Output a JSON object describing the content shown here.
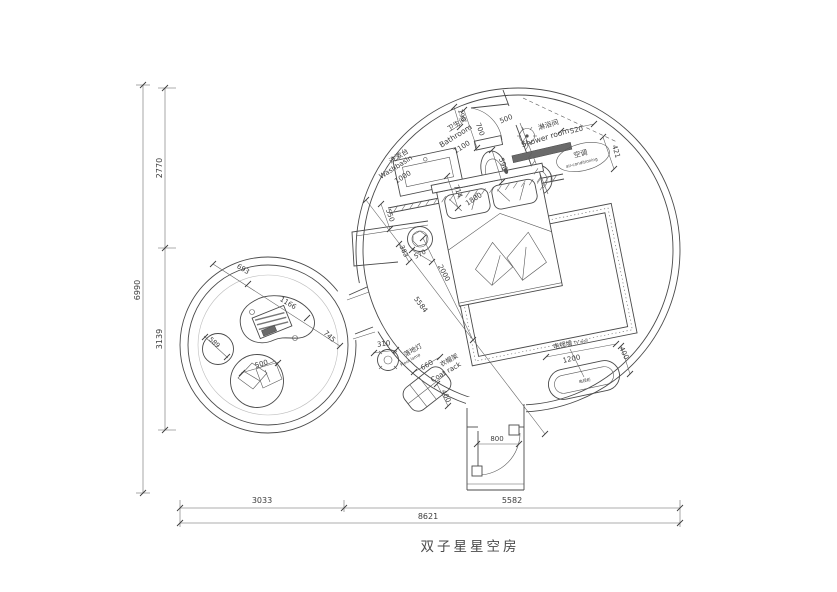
{
  "title": "双子星星空房",
  "drawing": {
    "line_color": "#4a4a4a",
    "background": "#ffffff"
  },
  "rooms": {
    "bathroom": {
      "zh": "卫生间",
      "en": "Bathroom"
    },
    "washbasin": {
      "zh": "洗漱台",
      "en": "Washbasin"
    },
    "shower": {
      "zh": "淋浴间",
      "en": "Shower room"
    },
    "air_conditioner": {
      "zh": "空调",
      "en": "air-conditioning"
    },
    "floor_lamp": {
      "zh": "落地灯",
      "en": "Floor lamp"
    },
    "coat_rack": {
      "zh": "衣帽架",
      "en": "Coat rack"
    },
    "tv_wall": {
      "zh": "电视墙",
      "en": "TV wall"
    },
    "tv_cabinet": {
      "zh": "电视柜"
    }
  },
  "overall_dimensions": {
    "total_width": "8621",
    "total_height": "6990",
    "left_top": "2770",
    "left_bottom": "3139",
    "bottom_left": "3033",
    "bottom_right": "5582"
  },
  "plan": {
    "labels": [
      {
        "n": "label-washbasin-zh",
        "t": "洗漱台",
        "x": 400,
        "y": 158,
        "r": -32,
        "s": 7
      },
      {
        "n": "label-washbasin-en",
        "t": "Washbasin",
        "x": 397,
        "y": 169,
        "r": -32,
        "s": 7
      },
      {
        "n": "dim-1000",
        "t": "1000",
        "x": 404,
        "y": 179,
        "r": -32,
        "s": 7
      },
      {
        "n": "label-bathroom-zh",
        "t": "卫生间",
        "x": 458,
        "y": 126,
        "r": -32,
        "s": 7
      },
      {
        "n": "label-bathroom-en",
        "t": "Bathroom",
        "x": 457,
        "y": 138,
        "r": -32,
        "s": 7.5
      },
      {
        "n": "dim-1100",
        "t": "1100",
        "x": 463,
        "y": 149,
        "r": -32,
        "s": 7
      },
      {
        "n": "dim-190",
        "t": "190",
        "x": 460,
        "y": 116,
        "r": 70,
        "s": 6.5
      },
      {
        "n": "dim-700",
        "t": "700",
        "x": 478,
        "y": 130,
        "r": 70,
        "s": 7
      },
      {
        "n": "dim-500-shower-door",
        "t": "500",
        "x": 507,
        "y": 121,
        "r": -22,
        "s": 7
      },
      {
        "n": "dim-590",
        "t": "590",
        "x": 501,
        "y": 165,
        "r": 70,
        "s": 7
      },
      {
        "n": "dim-714",
        "t": "714",
        "x": 456,
        "y": 192,
        "r": 70,
        "s": 7
      },
      {
        "n": "dim-550",
        "t": "550",
        "x": 388,
        "y": 216,
        "r": 70,
        "s": 7
      },
      {
        "n": "dim-1800",
        "t": "1800",
        "x": 475,
        "y": 201,
        "r": -33,
        "s": 7
      },
      {
        "n": "label-shower-zh",
        "t": "淋浴间",
        "x": 549,
        "y": 127,
        "r": -17,
        "s": 7
      },
      {
        "n": "label-shower-en",
        "t": "Shower room",
        "x": 546,
        "y": 140,
        "r": -17,
        "s": 7.5
      },
      {
        "n": "dim-520",
        "t": "520",
        "x": 577,
        "y": 132,
        "r": -14,
        "s": 7
      },
      {
        "n": "dim-421",
        "t": "421",
        "x": 614,
        "y": 152,
        "r": 74,
        "s": 7
      },
      {
        "n": "label-ac-zh",
        "t": "空调",
        "x": 581,
        "y": 156,
        "r": -14,
        "s": 7
      },
      {
        "n": "label-ac-en",
        "t": "air-conditioning",
        "x": 582,
        "y": 164,
        "r": -14,
        "s": 4.2
      },
      {
        "n": "dim-383",
        "t": "383",
        "x": 402,
        "y": 252,
        "r": 65,
        "s": 6.5
      },
      {
        "n": "dim-570",
        "t": "570",
        "x": 421,
        "y": 256,
        "r": -28,
        "s": 6.5
      },
      {
        "n": "dim-2000",
        "t": "2000",
        "x": 442,
        "y": 274,
        "r": 62,
        "s": 7
      },
      {
        "n": "dim-5584",
        "t": "5584",
        "x": 419,
        "y": 306,
        "r": 53,
        "s": 7
      },
      {
        "n": "dim-693",
        "t": "693",
        "x": 242,
        "y": 271,
        "r": 31,
        "s": 7
      },
      {
        "n": "dim-1166",
        "t": "1166",
        "x": 287,
        "y": 305,
        "r": 31,
        "s": 7
      },
      {
        "n": "dim-745",
        "t": "745",
        "x": 328,
        "y": 338,
        "r": 43,
        "s": 7
      },
      {
        "n": "dim-589",
        "t": "589",
        "x": 213,
        "y": 344,
        "r": 42,
        "s": 6.5
      },
      {
        "n": "dim-500-pillows",
        "t": "500",
        "x": 262,
        "y": 366,
        "r": -16,
        "s": 7
      },
      {
        "n": "dim-310",
        "t": "310",
        "x": 384,
        "y": 346,
        "r": -8,
        "s": 7
      },
      {
        "n": "label-floor-lamp-zh",
        "t": "落地灯",
        "x": 414,
        "y": 352,
        "r": -30,
        "s": 6.5
      },
      {
        "n": "label-floor-lamp-en",
        "t": "Floor lamp",
        "x": 411,
        "y": 361,
        "r": -30,
        "s": 4.2
      },
      {
        "n": "dim-660",
        "t": "660",
        "x": 428,
        "y": 367,
        "r": -30,
        "s": 7
      },
      {
        "n": "label-coat-rack-zh",
        "t": "衣帽架",
        "x": 450,
        "y": 362,
        "r": -30,
        "s": 6.5
      },
      {
        "n": "label-coat-rack-en",
        "t": "Coat rack",
        "x": 447,
        "y": 374,
        "r": -30,
        "s": 7
      },
      {
        "n": "dim-400-coat",
        "t": "400",
        "x": 444,
        "y": 397,
        "r": 65,
        "s": 7
      },
      {
        "n": "label-tv-wall-zh",
        "t": "电视墙",
        "x": 563,
        "y": 347,
        "r": -12,
        "s": 6.5
      },
      {
        "n": "label-tv-wall-en",
        "t": "TV wall",
        "x": 581,
        "y": 343,
        "r": -12,
        "s": 4
      },
      {
        "n": "dim-1200",
        "t": "1200",
        "x": 572,
        "y": 361,
        "r": -12,
        "s": 7
      },
      {
        "n": "dim-400-tv",
        "t": "400",
        "x": 622,
        "y": 354,
        "r": 65,
        "s": 7
      },
      {
        "n": "label-tv-cabinet",
        "t": "电视柜",
        "x": 585,
        "y": 382,
        "r": -12,
        "s": 4
      },
      {
        "n": "dim-800",
        "t": "800",
        "x": 497,
        "y": 441,
        "r": 0,
        "s": 7
      },
      {
        "n": "dim-2770",
        "t": "2770",
        "x": 162,
        "y": 168,
        "r": -90,
        "s": 8
      },
      {
        "n": "dim-3139",
        "t": "3139",
        "x": 162,
        "y": 339,
        "r": -90,
        "s": 8
      },
      {
        "n": "dim-6990",
        "t": "6990",
        "x": 140,
        "y": 290,
        "r": -90,
        "s": 8
      },
      {
        "n": "dim-3033",
        "t": "3033",
        "x": 262,
        "y": 503,
        "r": 0,
        "s": 8
      },
      {
        "n": "dim-5582",
        "t": "5582",
        "x": 512,
        "y": 503,
        "r": 0,
        "s": 8
      },
      {
        "n": "dim-8621",
        "t": "8621",
        "x": 428,
        "y": 519,
        "r": 0,
        "s": 8
      }
    ]
  }
}
